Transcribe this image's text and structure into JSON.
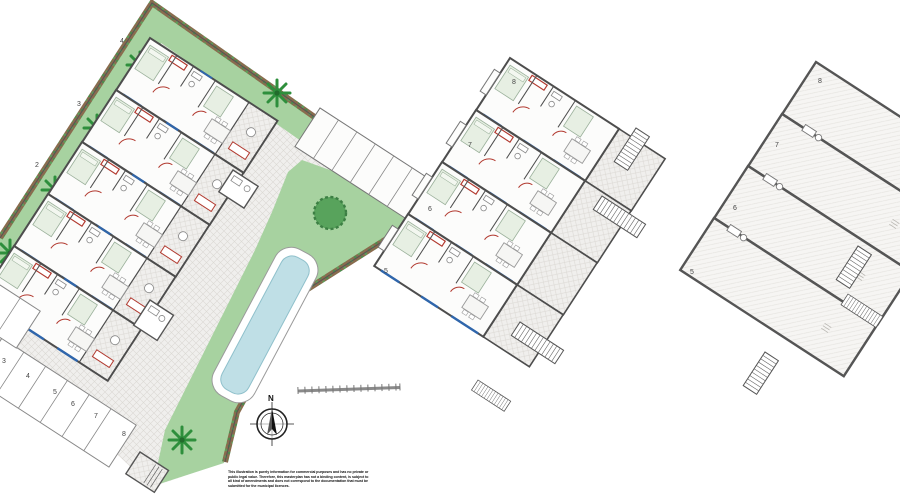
{
  "plans": {
    "ground": {
      "name": "Ground floor site plan",
      "unit_labels": [
        "4",
        "3",
        "2"
      ],
      "parking_labels": [
        "3",
        "4",
        "5",
        "6",
        "7",
        "8"
      ]
    },
    "first": {
      "name": "First floor plan",
      "unit_labels": [
        "8",
        "7",
        "6",
        "5"
      ]
    },
    "solarium": {
      "name": "Solarium / roof plan",
      "unit_labels": [
        "8",
        "7",
        "6",
        "5"
      ]
    }
  },
  "compass": {
    "north_label": "N"
  },
  "disclaimer": {
    "lines": [
      "This illustration is purely information for commercial purposes and has no private or",
      "public legal value. Therefore, this masterplan has not a binding content, is subject to",
      "all kind of amendments and does not correspond to the documentation that must be",
      "submitted for the municipal licences."
    ]
  },
  "colors": {
    "lawn": "#a7d2a0",
    "pool_water": "#bfdfe6",
    "hedge_brown": "#8a6b4e",
    "wall_gray": "#4d4d4d",
    "door_red": "#b23a30",
    "window_blue": "#2f66ac",
    "paving": "#f0efed"
  }
}
